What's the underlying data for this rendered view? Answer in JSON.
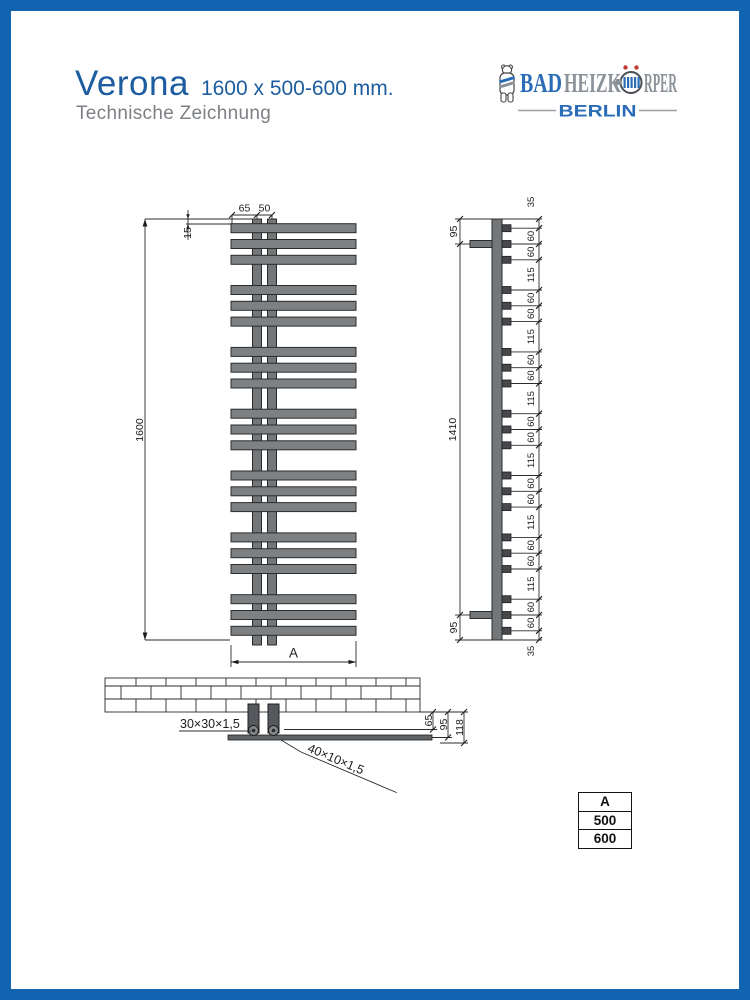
{
  "page": {
    "title": "Verona",
    "size_text": "1600 x 500-600 mm.",
    "subtitle": "Technische Zeichnung"
  },
  "logo": {
    "brand_prefix": "BAD",
    "brand_mid": "HEIZK",
    "brand_suffix": "RPER",
    "city": "BERLIN"
  },
  "front_view": {
    "dim_top_left": "65",
    "dim_top_right": "50",
    "dim_offset_top": "15",
    "dim_height": "1600",
    "dim_width_label": "A"
  },
  "side_view": {
    "dim_bracket_top": "95",
    "dim_bracket_span": "1410",
    "dim_bracket_bottom": "95",
    "chain": [
      "35",
      "60",
      "60",
      "115",
      "60",
      "60",
      "115",
      "60",
      "60",
      "115",
      "60",
      "60",
      "115",
      "60",
      "60",
      "115",
      "60",
      "60",
      "115",
      "60",
      "60",
      "35"
    ]
  },
  "detail_view": {
    "label_square_tube": "30×30×1,5",
    "label_flat_bar": "40×10×1,5",
    "dim_tube_depth": "65",
    "dim_bar_depth": "95",
    "dim_total_depth": "118"
  },
  "size_table": {
    "header": "A",
    "rows": [
      "500",
      "600"
    ]
  },
  "colors": {
    "frame_blue": "#1263b2",
    "title_blue": "#1d5c9e",
    "logo_blue": "#2a6cb5",
    "text_gray": "#7d8084",
    "drawing_gray": "#7e8184"
  }
}
